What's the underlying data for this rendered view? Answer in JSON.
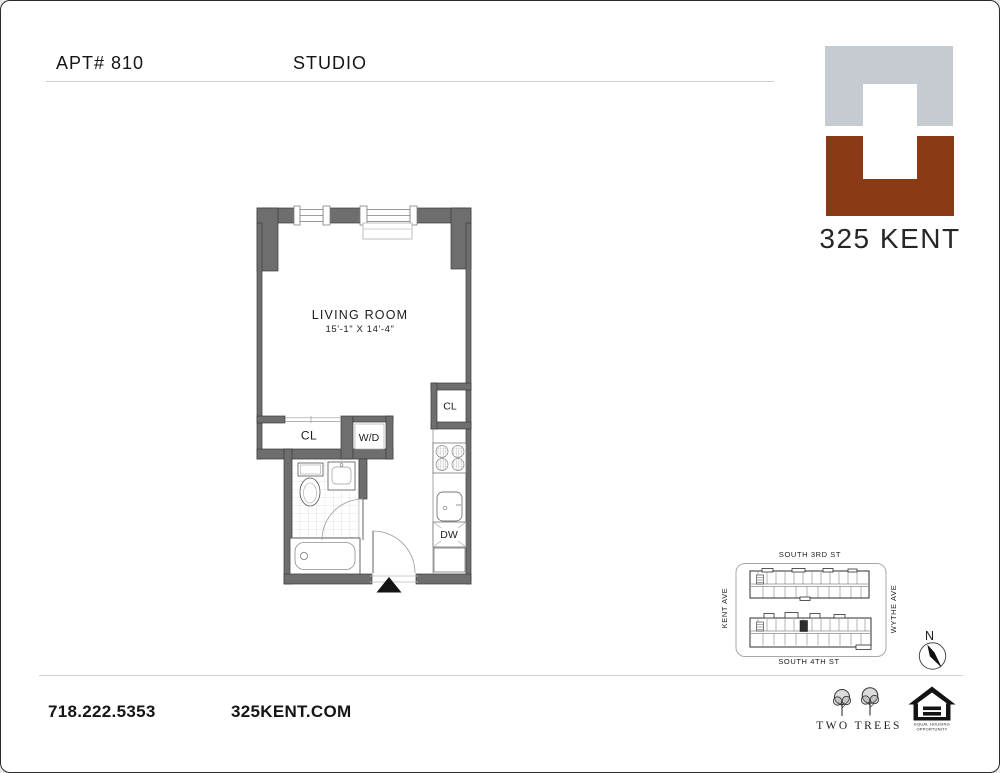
{
  "header": {
    "apt_label": "APT# 810",
    "unit_type": "STUDIO"
  },
  "logo": {
    "building_name": "325 KENT",
    "gray": "#c5cbd1",
    "brown": "#8a3a15"
  },
  "floorplan": {
    "room_name": "LIVING ROOM",
    "room_dimensions": "15'-1\" X 14'-4\"",
    "closet_label": "CL",
    "kitchen_closet_label": "CL",
    "washer_dryer_label": "W/D",
    "dishwasher_label": "DW",
    "wall_color": "#6e6e6e"
  },
  "site_map": {
    "street_top": "SOUTH 3RD ST",
    "street_bottom": "SOUTH 4TH ST",
    "street_left": "KENT AVE",
    "street_right": "WYTHE AVE",
    "north_label": "N"
  },
  "footer": {
    "phone": "718.222.5353",
    "website": "325KENT.COM",
    "developer_name": "TWO TREES",
    "eho_line1": "EQUAL HOUSING",
    "eho_line2": "OPPORTUNITY"
  }
}
